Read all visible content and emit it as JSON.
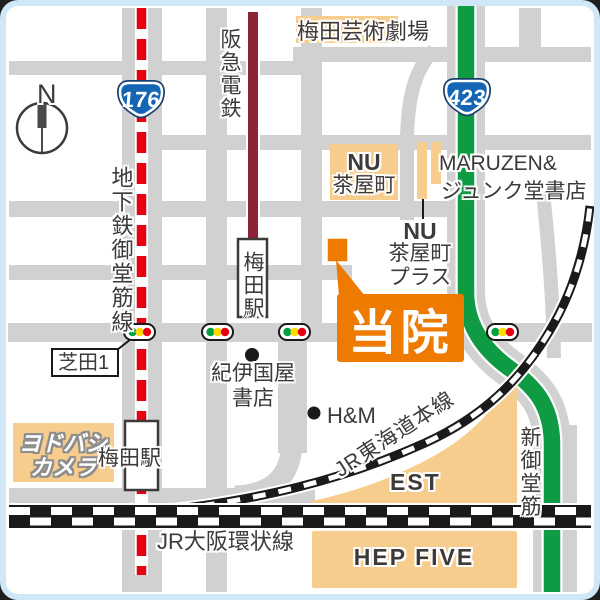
{
  "map": {
    "compass": {
      "label": "N"
    },
    "badges": {
      "route176": "176",
      "route423": "423"
    },
    "lines": {
      "subway_midosuji": "地下鉄御堂筋線",
      "hankyu": "阪急電鉄",
      "jr_tokaido": "JR東海道本線",
      "jr_loop": "JR大阪環状線",
      "shin_midosuji": "新御堂筋"
    },
    "stations": {
      "hankyu_umeda": "梅田駅",
      "jr_umeda": "梅田駅"
    },
    "clinic": {
      "label": "当院"
    },
    "intersection": {
      "label": "芝田1"
    },
    "landmarks": {
      "umeda_arts_theater": "梅田芸術劇場",
      "nu_chayamachi": {
        "n": "N",
        "u": "U",
        "name": "茶屋町"
      },
      "maruzen": {
        "line1": "MARUZEN&",
        "line2": "ジュンク堂書店"
      },
      "nu_chayamachi_plus": {
        "n": "N",
        "u": "U",
        "name": "茶屋町",
        "suffix": "プラス"
      },
      "kinokuniya": {
        "line1": "紀伊国屋",
        "line2": "書店"
      },
      "hm": "H&M",
      "yodobashi": {
        "line1": "ヨドバシ",
        "line2": "カメラ"
      },
      "est": "EST",
      "hep_five": "HEP FIVE"
    },
    "colors": {
      "clinic_orange": "#ef7a00",
      "building_peach": "#f7cd8e",
      "road_gray": "#d1d1d1",
      "subway_red": "#e60012",
      "green_road": "#0f9b44",
      "hankyu_maroon": "#8e2237",
      "route_badge_blue": "#1465b3",
      "frame_blue": "#cfe7f7",
      "signal_green": "#00a040",
      "signal_yellow": "#ffd900",
      "signal_red": "#e60012"
    }
  }
}
